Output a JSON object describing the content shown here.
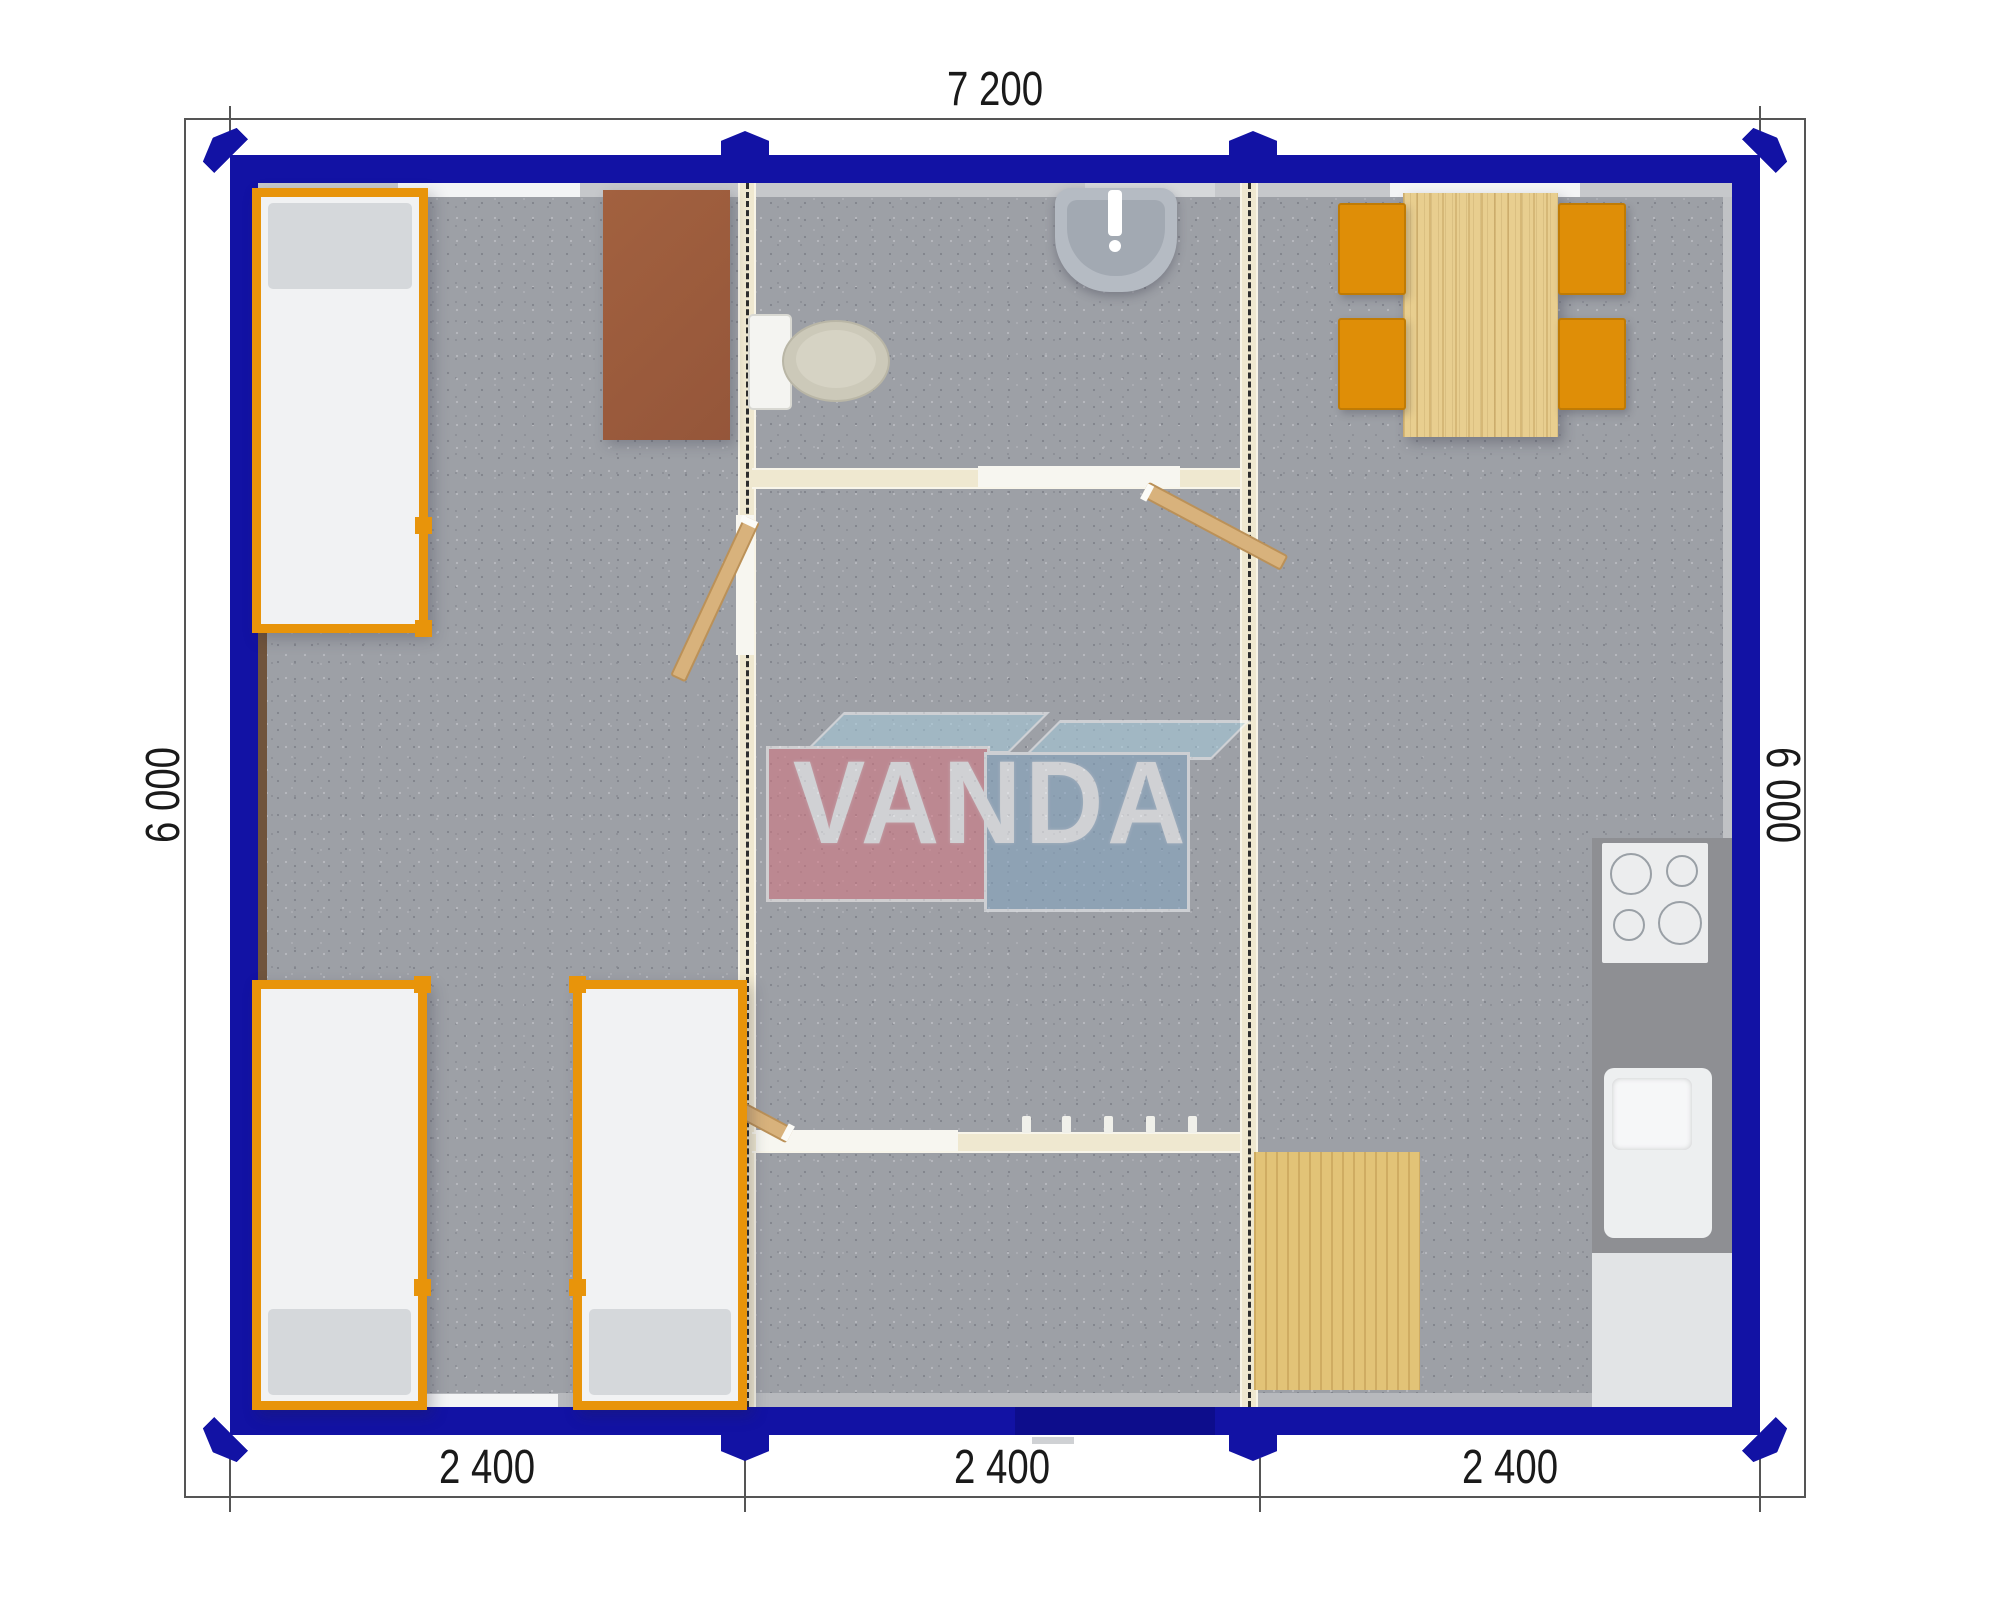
{
  "title": "Modular building floor plan",
  "dimensions": {
    "top": "7 200",
    "left": "6 000",
    "right": "6 000",
    "bottom": [
      "2 400",
      "2 400",
      "2 400"
    ]
  },
  "watermark": {
    "text": "VANDA",
    "box_left_color": "#D9737F",
    "box_right_color": "#82A4C2",
    "top_face_color": "#A5CCDF"
  },
  "colors": {
    "outer_wall": "#1212A4",
    "entrance_door": "#0D0D8C",
    "floor": "#9DA0A6",
    "partition": "#EFE8D0",
    "bed_frame": "#E8940A",
    "chair": "#DF8E07",
    "table_wood": "#E8CE8F",
    "floor_mat_wood": "#E2C377",
    "wardrobe": "#9C5A3D",
    "kitchen_counter": "#8E8F93"
  },
  "modules": {
    "count": 3,
    "module_width_mm": "2 400",
    "length_mm": "7 200",
    "depth_mm": "6 000"
  },
  "furniture": {
    "beds": 3,
    "wardrobe": 1,
    "toilet": 1,
    "wash_basin": 1,
    "dining_table": 1,
    "chairs": 4,
    "stove": 1,
    "kitchen_sink": 1,
    "kitchen_cabinet": 1,
    "wood_floor_mat": 1,
    "coat_hooks": 5,
    "interior_doors": 3,
    "entrance_door": 1,
    "windows": 4
  }
}
